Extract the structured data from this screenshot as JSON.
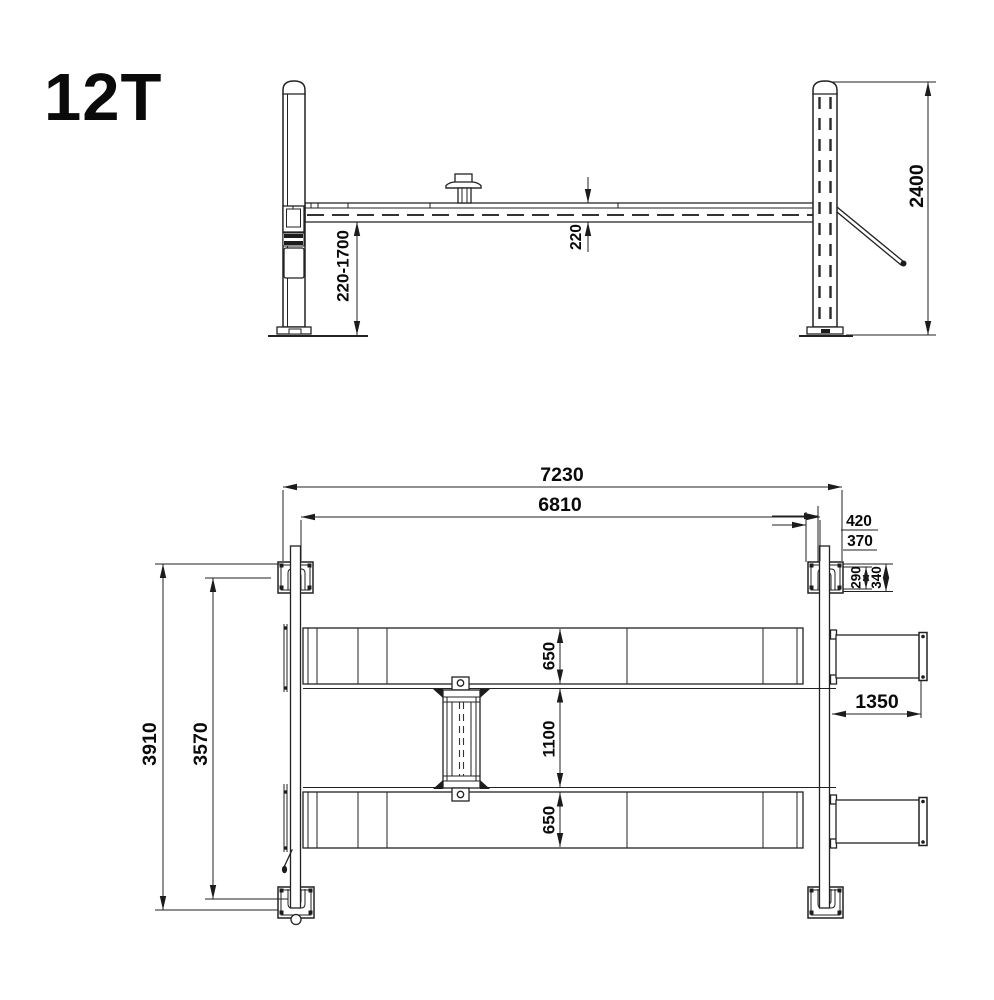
{
  "title": "12T",
  "dims": {
    "lift_range": "220-1700",
    "runway_thickness": "220",
    "column_height": "2400",
    "overall_length": "7230",
    "inner_length": "6810",
    "offset_420": "420",
    "offset_370": "370",
    "plate_290": "290",
    "plate_340": "340",
    "runway_width_front": "650",
    "runway_gap": "1100",
    "runway_width_rear": "650",
    "ramp_length": "1350",
    "overall_width": "3910",
    "inner_width": "3570"
  },
  "colors": {
    "ink": "#1c1c1c",
    "paper": "#ffffff"
  }
}
